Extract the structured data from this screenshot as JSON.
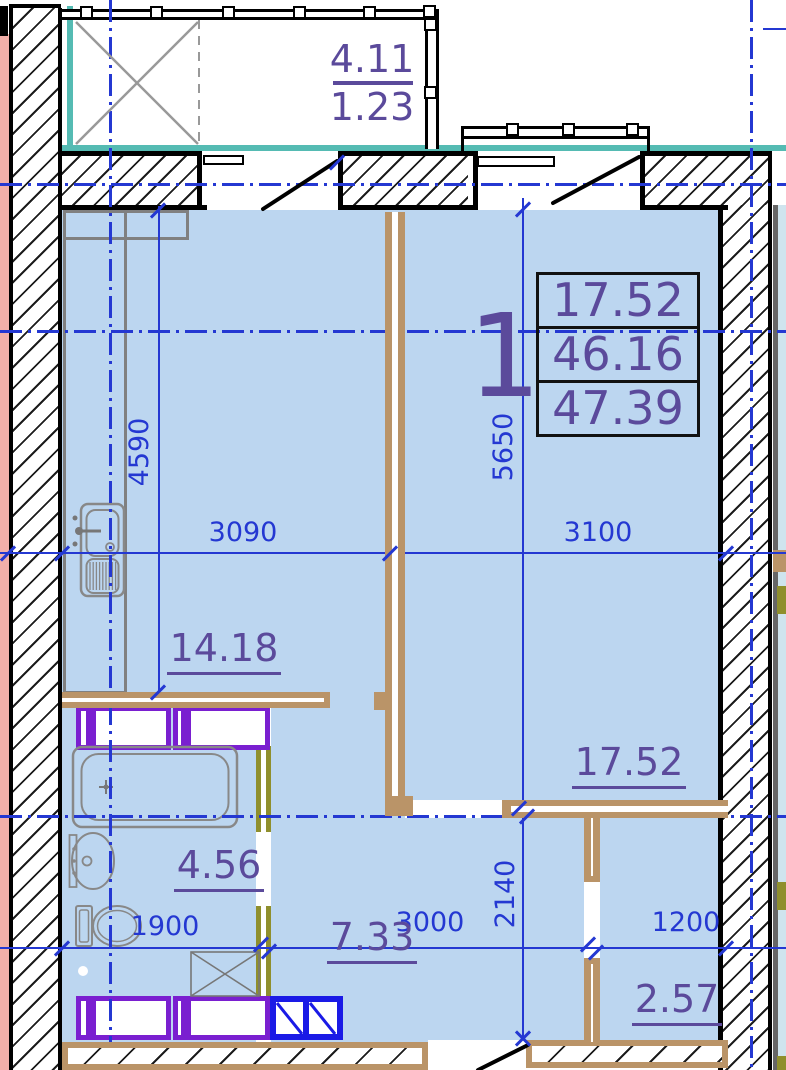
{
  "title_block": {
    "apartment_number": "1",
    "areas": [
      "17.52",
      "46.16",
      "47.39"
    ]
  },
  "balcony": {
    "area_upper": "4.11",
    "area_lower": "1.23"
  },
  "rooms": {
    "kitchen_living": "14.18",
    "bedroom": "17.52",
    "bathroom": "4.56",
    "hall": "7.33",
    "storage": "2.57"
  },
  "dims": {
    "w_kitchen": "3090",
    "w_bedroom": "3100",
    "h_kitchen": "4590",
    "h_bedroom": "5650",
    "w_bath": "1900",
    "w_hall": "3000",
    "h_hall": "2140",
    "w_storage": "1200"
  },
  "labels": {
    "fire_cabinet": "ПК"
  },
  "colors": {
    "room_fill": "#BCD6F0",
    "wall_tan": "#BA9468",
    "fixture_purple": "#7A1FD0",
    "fixture_blue": "#1A1AE6",
    "window_teal": "#55BBB3",
    "dimension_blue": "#2438D2",
    "area_text_purple": "#5B4A9B",
    "neighbor_pink": "#F2AFA9",
    "door_jamb_olive": "#8F8F2D",
    "fire_cabinet_red": "#E53022"
  }
}
